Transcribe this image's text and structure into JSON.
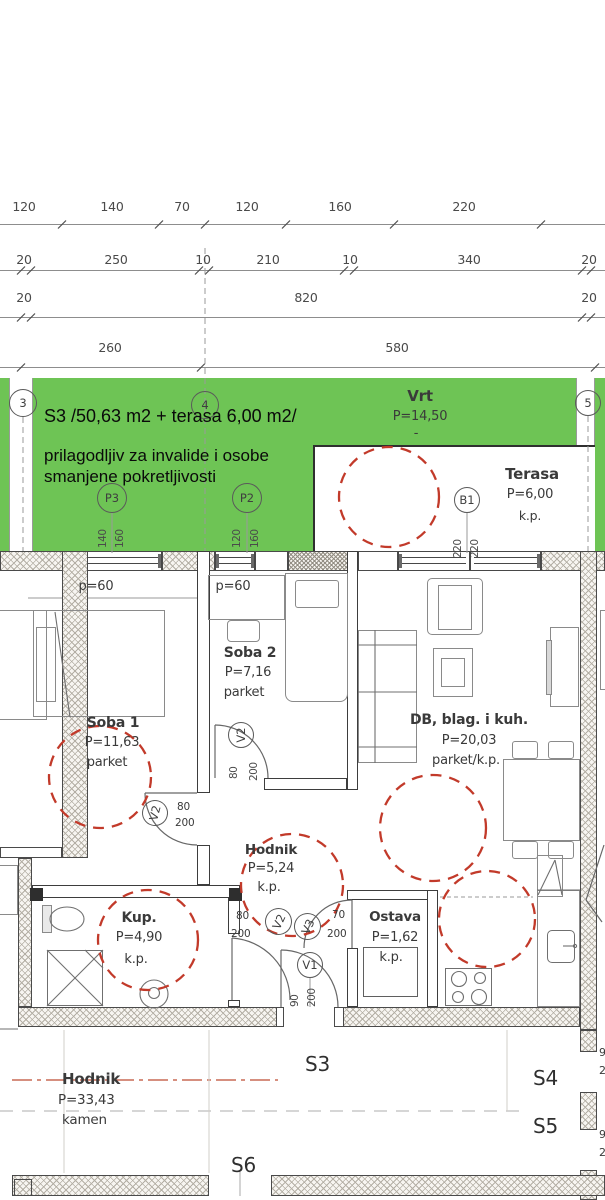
{
  "dimensions": {
    "row1": [
      "120",
      "140",
      "70",
      "120",
      "160",
      "220"
    ],
    "row2": [
      "20",
      "250",
      "10",
      "210",
      "10",
      "340",
      "20"
    ],
    "row3": [
      "20",
      "820",
      "20"
    ],
    "row4": [
      "260",
      "580"
    ]
  },
  "banner": {
    "title": "S3 /50,63 m2 + terasa 6,00 m2/",
    "subtitle1": "prilagodljiv za invalide i osobe",
    "subtitle2": "smanjene pokretljivosti"
  },
  "garden": {
    "name": "Vrt",
    "area": "P=14,50",
    "dash": "-"
  },
  "terrace": {
    "name": "Terasa",
    "area": "P=6,00",
    "floor": "k.p."
  },
  "markers": {
    "m3": "3",
    "m4": "4",
    "m5": "5",
    "p3": {
      "label": "P3",
      "dim1": "140",
      "dim2": "160"
    },
    "p2": {
      "label": "P2",
      "dim1": "120",
      "dim2": "160"
    },
    "b1": {
      "label": "B1",
      "dim1": "220",
      "dim2": "220"
    }
  },
  "rooms": {
    "soba1": {
      "name": "Soba 1",
      "area": "P=11,63",
      "floor": "parket",
      "parapet": "p=60"
    },
    "soba2": {
      "name": "Soba 2",
      "area": "P=7,16",
      "floor": "parket",
      "parapet": "p=60"
    },
    "living": {
      "name": "DB, blag. i kuh.",
      "area": "P=20,03",
      "floor": "parket/k.p."
    },
    "hodnik": {
      "name": "Hodnik",
      "area": "P=5,24",
      "floor": "k.p."
    },
    "kup": {
      "name": "Kup.",
      "area": "P=4,90",
      "floor": "k.p."
    },
    "ostava": {
      "name": "Ostava",
      "area": "P=1,62",
      "floor": "k.p."
    }
  },
  "doors": {
    "v1": {
      "label": "V1",
      "w": "90",
      "h": "200"
    },
    "v2_soba1": {
      "label": "V2",
      "w": "80",
      "h": "200"
    },
    "v2_soba2": {
      "label": "V2",
      "w": "80",
      "h": "200"
    },
    "v2_kup": {
      "label": "V2",
      "w": "80",
      "h": "200"
    },
    "v3_ostava": {
      "label": "V3",
      "w": "70",
      "h": "200"
    }
  },
  "corridor": {
    "name": "Hodnik",
    "area": "P=33,43",
    "floor": "kamen"
  },
  "units": {
    "s3": "S3",
    "s4": "S4",
    "s5": "S5",
    "s6": "S6"
  },
  "edge_dims": [
    "9",
    "2",
    "9",
    "2"
  ],
  "colors": {
    "garden_green": "#6ec455",
    "accessibility_red": "#c23a2a",
    "axis_red": "#c96a55"
  }
}
